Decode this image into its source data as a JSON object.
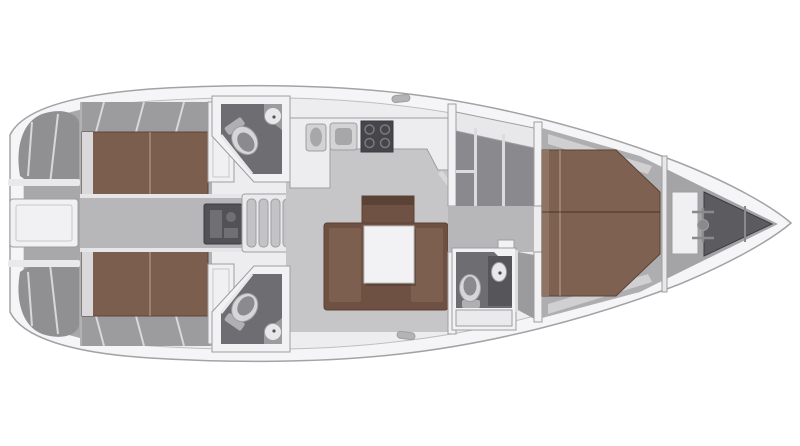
{
  "canvas": {
    "width": 800,
    "height": 446,
    "background": "#ffffff"
  },
  "diagram": {
    "type": "sailboat-interior-floor-plan",
    "orientation": "bow-right",
    "features": [
      "hull",
      "cockpit",
      "transom-locker",
      "companionway-steps",
      "engine",
      "port-aft-cabin-berth",
      "starboard-aft-cabin-berth",
      "port-aft-head",
      "starboard-aft-head",
      "galley",
      "saloon-sofa",
      "saloon-table",
      "sideboard",
      "wardrobe",
      "forward-head",
      "shower",
      "forward-cabin-berth",
      "anchor-windlass",
      "anchor-locker",
      "deck-cleats"
    ]
  },
  "colors": {
    "hull": "#f5f5f7",
    "interior": "#ededef",
    "cockpit": "#a8a8ab",
    "seat": "#909093",
    "ledge": "#e9e9eb",
    "transom_box": "#f1f1f3",
    "corridor": "#b7b7ba",
    "corridor_edge": "#e6e6e8",
    "cabin_floor": "#b2b2b5",
    "bench": "#9c9c9f",
    "berth_aft": "#7b5e4e",
    "berth_fwd": "#7e6150",
    "berth_edge_light": "#8f7363",
    "headboard": "#d9d9db",
    "wardrobe_white": "#f0f0f2",
    "head_wall": "#f2f2f4",
    "head_floor": "#6e6e72",
    "toilet_body": "#d6d6d8",
    "toilet_seat": "#8b8b8f",
    "toilet_tank": "#b0b0b3",
    "sink_basin": "#e8e8ea",
    "sink_counter": "#9c9c9f",
    "engine": "#515156",
    "engine_detail": "#6f6f74",
    "steps_frame": "#eaeaec",
    "tread": "#c3c3c6",
    "galley": "#ededef",
    "appliance": "#d3d3d5",
    "basin_dark": "#a7a7aa",
    "stove": "#45454a",
    "stove_handle": "#c6c6c9",
    "saloon_floor": "#c6c6c9",
    "sofa_outer": "#6e5142",
    "sofa_seat": "#7d5f4f",
    "sideboard": "#6f5244",
    "sideboard_top": "#5a4236",
    "table": "#f2f2f4",
    "bulkhead": "#f2f2f4",
    "wardrobe_room": "#8a8a8e",
    "shelf_line": "#dcdcde",
    "locker_band": "#e8e8ea",
    "sink_panel": "#55555a",
    "cabinet": "#eaeaec",
    "shower": "#9b9b9e",
    "fwd_floor": "#aeaeb1",
    "fwd_shelf": "#d0d0d3",
    "windlass_box": "#f0f0f2",
    "metal": "#8a8a8d",
    "bow_deck": "#a4a4a7",
    "anchor_locker": "#5c5c60",
    "cleat": "#b3b3b6",
    "table_shadow": "rgba(60,45,35,0.35)"
  }
}
